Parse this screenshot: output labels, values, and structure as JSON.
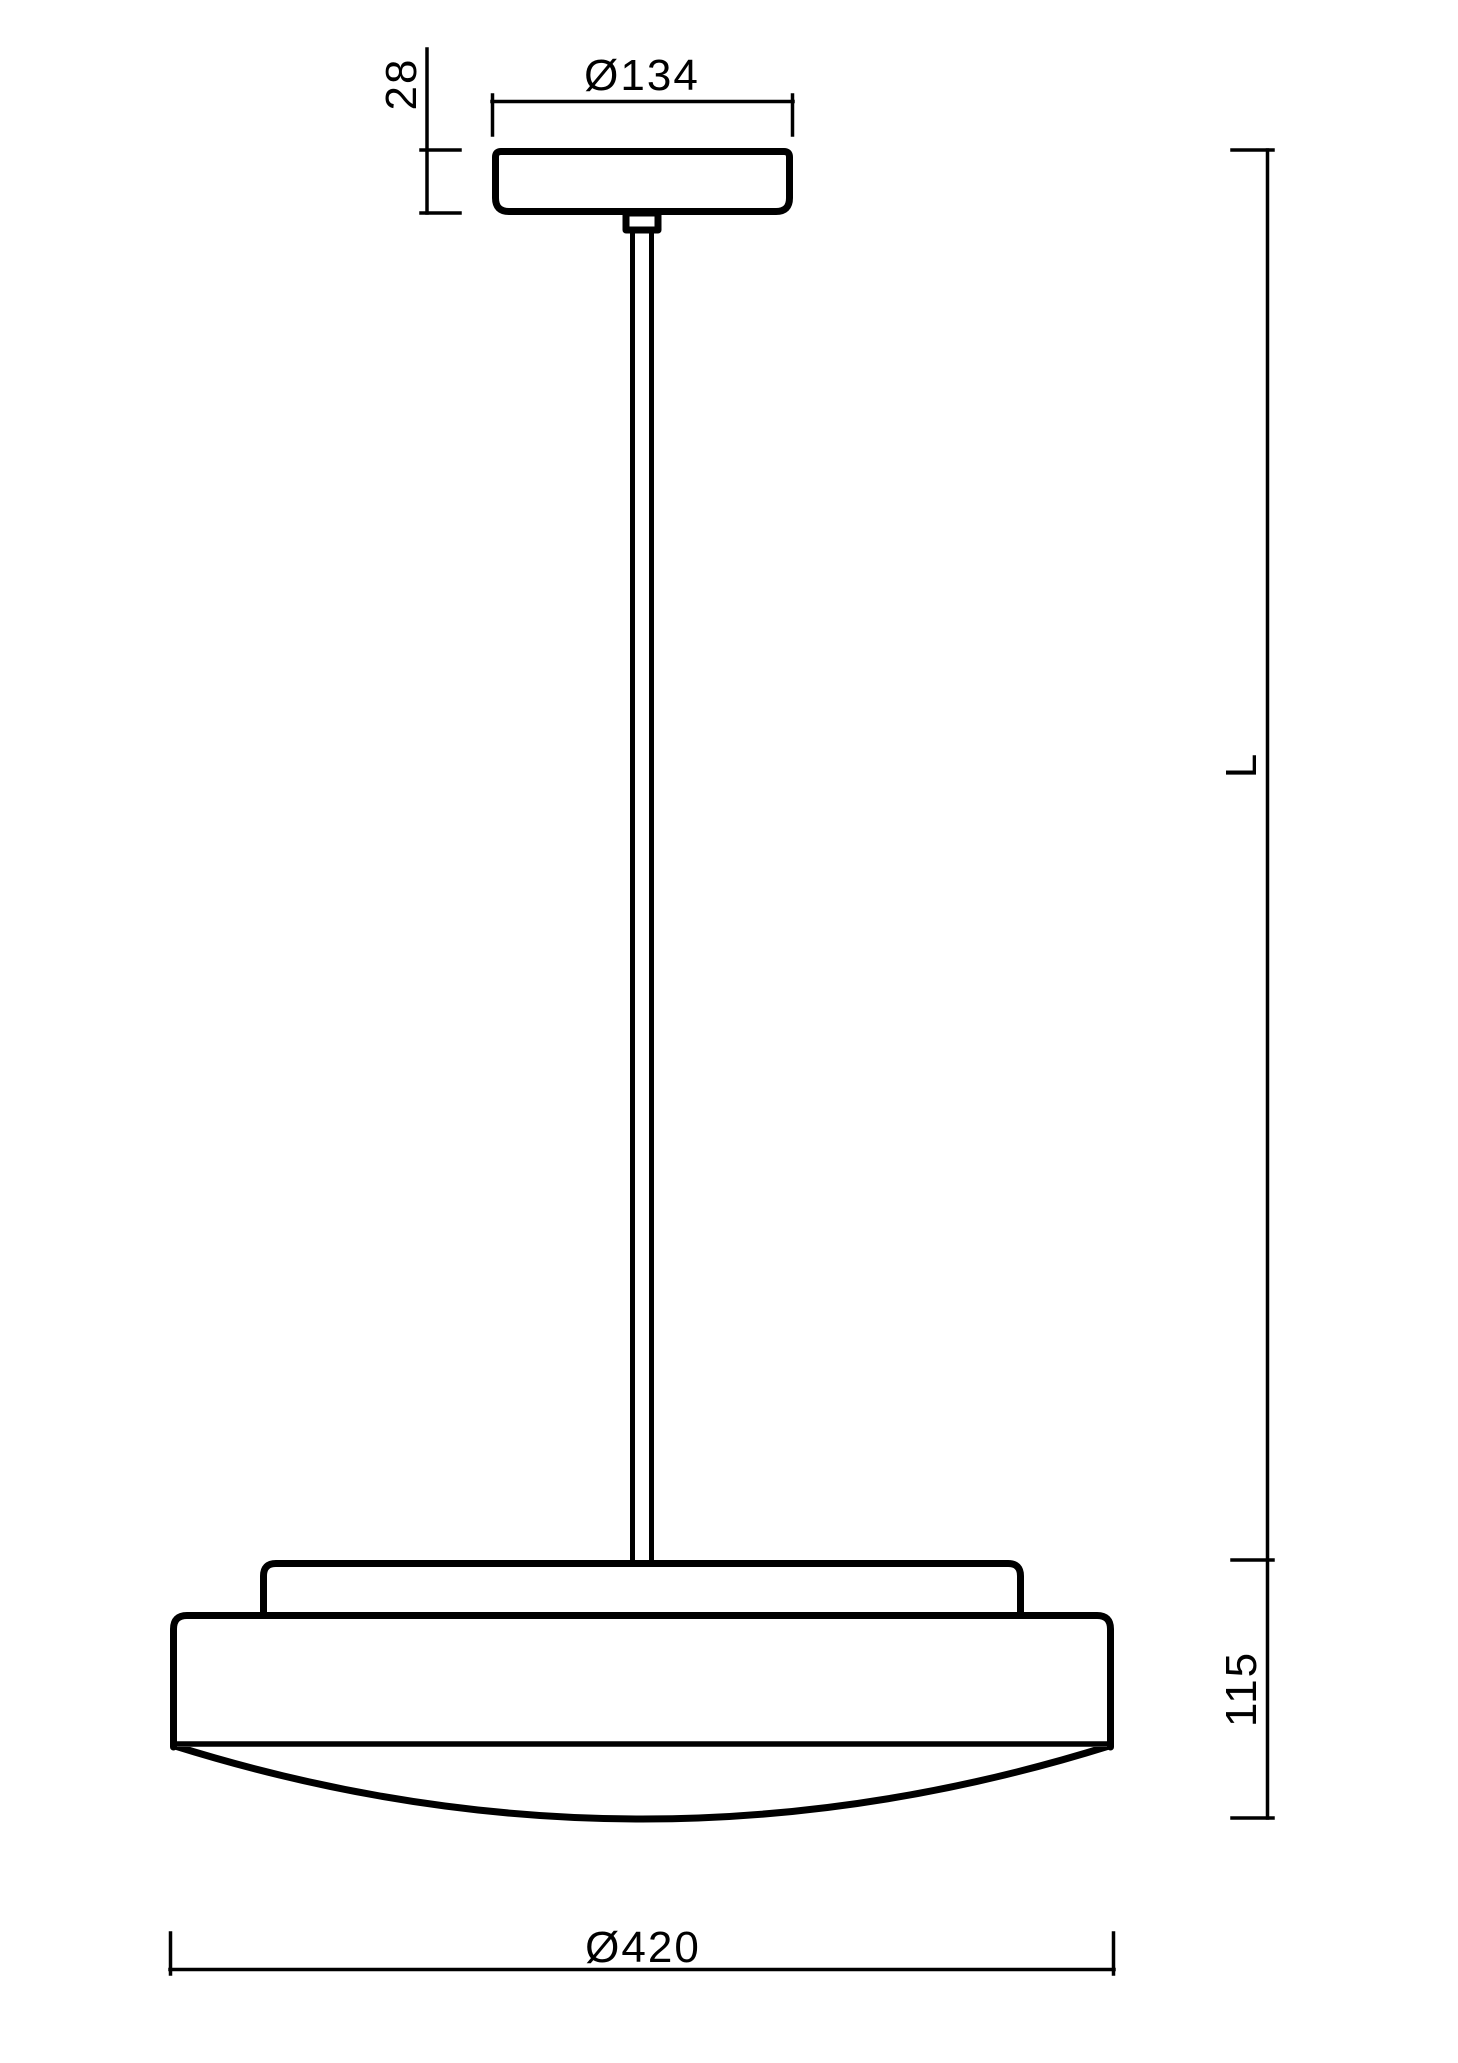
{
  "drawing": {
    "title": "pendant luminaire dimension drawing",
    "background_color": "#ffffff",
    "line_color": "#000000",
    "dimensions": {
      "canopy_height": {
        "label": "28"
      },
      "canopy_diameter": {
        "label": "Ø134"
      },
      "suspension_length": {
        "label": "L"
      },
      "body_height": {
        "label": "115"
      },
      "body_diameter": {
        "label": "Ø420"
      }
    }
  }
}
